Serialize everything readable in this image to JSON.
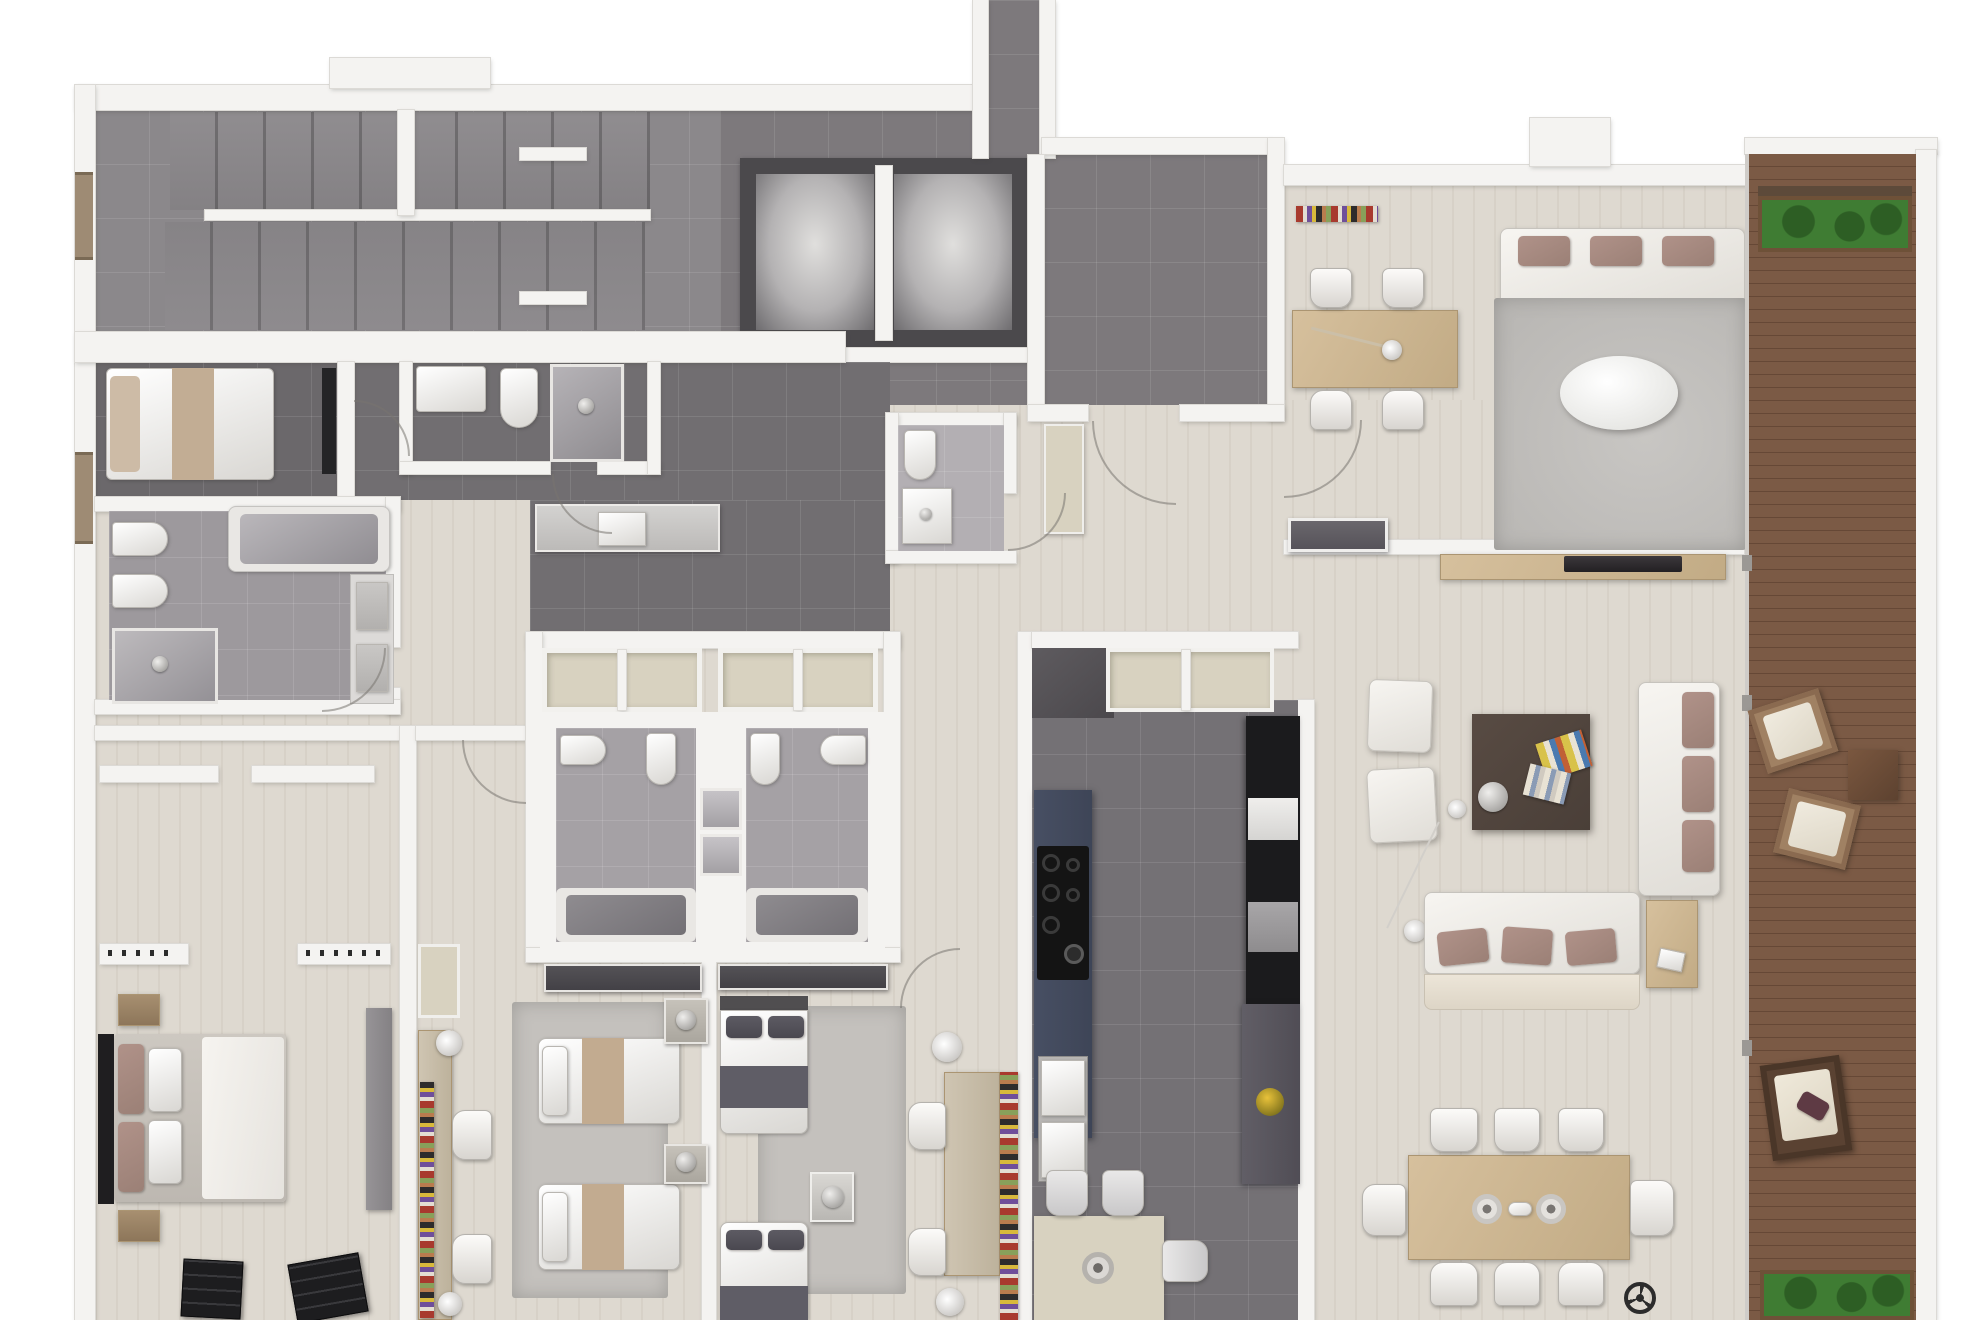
{
  "app": {
    "type": "floor-plan-rendering",
    "description": "Top-down 3D rendered apartment floor plan, no text labels visible",
    "visible_text": []
  },
  "palette": {
    "wall": "#f4f3f1",
    "wall_edge": "#dcdad6",
    "wood": "#ded9d0",
    "wood_grain": "rgba(120,105,85,0.07)",
    "tile_stair": "#8b888b",
    "tile_hall": "#7d797c",
    "tile_dark": "#716e71",
    "tile_bed1": "#6b686b",
    "tile_kitchen": "#747175",
    "bath_master": "#9d999d",
    "bath_center": "#a5a1a5",
    "bath_wc": "#b3afb3",
    "deck": "#7b5a45",
    "deck_line": "rgba(40,20,10,0.25)",
    "green": "#3f7c33",
    "green_dark": "#2d5e24",
    "navy": "#3e4557",
    "mauve": "#b09289",
    "wood_furniture": "#d6c09d",
    "table_dark": "#4a3f38",
    "chair_black": "#1d1d1f",
    "rug": "#c4c1bd",
    "rug_living": "#b7b5b2",
    "appliance_black": "#1b1b1d",
    "silver": "#c9c8c9",
    "closet_beige": "#d8d2c0"
  },
  "rooms": [
    {
      "id": "staircase-hall",
      "label": "Staircase hall"
    },
    {
      "id": "elevator-lobby",
      "label": "Elevator lobby with two elevator shafts"
    },
    {
      "id": "entry-hall",
      "label": "Entry hall, dark tile"
    },
    {
      "id": "bedroom-1",
      "label": "Small bedroom with single bed"
    },
    {
      "id": "bathroom-upper",
      "label": "Bathroom with sink, toilet, shower"
    },
    {
      "id": "master-bathroom",
      "label": "Master bathroom with bidet, toilet, shower, bathtub, double vanity"
    },
    {
      "id": "guest-wc",
      "label": "Guest WC"
    },
    {
      "id": "laundry-corridor",
      "label": "Corridor with laundry counter"
    },
    {
      "id": "closet-row",
      "label": "Built-in closet row"
    },
    {
      "id": "bathroom-center-left",
      "label": "En-suite bathroom left (bidet, toilet, shower, tub)"
    },
    {
      "id": "bathroom-center-right",
      "label": "En-suite bathroom right (bidet, toilet, shower, tub)"
    },
    {
      "id": "master-bedroom",
      "label": "Master bedroom with walk-in closet"
    },
    {
      "id": "bedroom-2",
      "label": "Twin bedroom with two single beds and desk"
    },
    {
      "id": "bedroom-3",
      "label": "Bedroom with two single beds and desk"
    },
    {
      "id": "kitchen",
      "label": "Kitchen with navy island, cooktop, sinks, appliance wall"
    },
    {
      "id": "study",
      "label": "Study with desk, four chairs, bookshelf"
    },
    {
      "id": "living-room",
      "label": "Living room with sofas, coffee table, TV sideboard"
    },
    {
      "id": "dining-area",
      "label": "Dining area with table for eight"
    },
    {
      "id": "terrace",
      "label": "Wooden deck terrace with planters and lounge chairs"
    }
  ],
  "furniture_inventory": [
    "stairs",
    "handrail",
    "elevator-cab x2",
    "single-bed",
    "double-bed",
    "twin-beds x4",
    "bidet x3",
    "toilet x5",
    "shower x5",
    "bathtub x3",
    "vanity-sinks",
    "laundry-sink",
    "kitchen-island",
    "cooktop-6-burner",
    "double-sink",
    "oven-column",
    "fridge",
    "breakfast-table",
    "dining-table-8-chairs",
    "study-desk-4-chairs",
    "desk-lamp",
    "bookshelves",
    "sofa x3",
    "armchairs x4",
    "barcelona-chairs x2",
    "coffee-table",
    "oval-side-table",
    "tv-sideboard",
    "arc-floor-lamp",
    "area-rugs x4",
    "deck-armchairs x3",
    "deck-side-table",
    "planters x2",
    "ceiling-fan-symbol"
  ]
}
